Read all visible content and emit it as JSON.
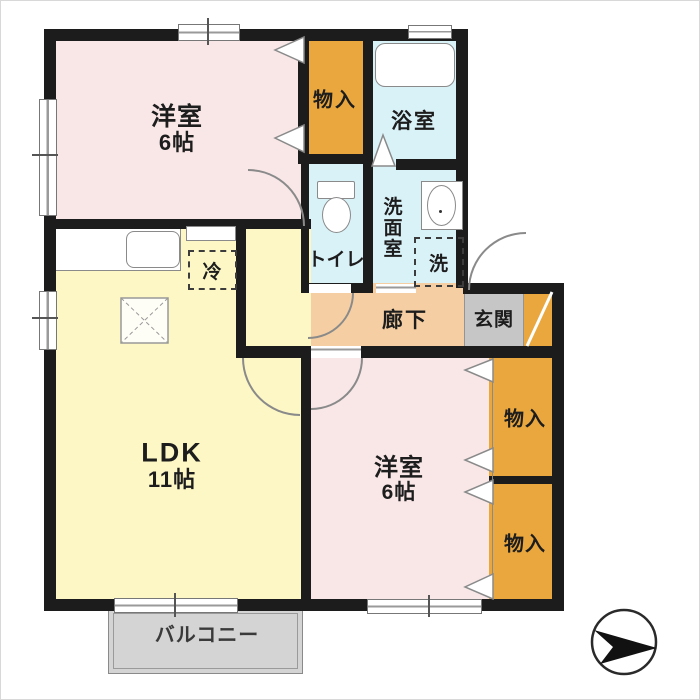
{
  "plan_title": "2LDK apartment floor plan",
  "rooms": {
    "bedroom1": {
      "name": "洋室",
      "size": "6帖"
    },
    "bedroom2": {
      "name": "洋室",
      "size": "6帖"
    },
    "ldk": {
      "name": "LDK",
      "size": "11帖"
    },
    "bath": {
      "name": "浴室"
    },
    "toilet": {
      "name": "トイレ"
    },
    "washroom": {
      "name": "洗面室"
    },
    "hallway": {
      "name": "廊下"
    },
    "entrance": {
      "name": "玄関"
    },
    "balcony": {
      "name": "バルコニー"
    },
    "storage_top": {
      "name": "物入"
    },
    "storage_right_upper": {
      "name": "物入"
    },
    "storage_right_lower": {
      "name": "物入"
    }
  },
  "appliances": {
    "refrigerator": "冷",
    "washer": "洗"
  },
  "icons": {
    "compass": "north-arrow-icon",
    "doors": "quarter-circle-swing",
    "closets": "folding-door-chevron"
  },
  "colors": {
    "wall": "#1c1c1c",
    "bedroom": "#f9e7e7",
    "ldk": "#fcf7c5",
    "wet_area": "#d9f2f8",
    "hallway": "#f5cfa3",
    "storage": "#e9a73e",
    "entrance_floor": "#c6c6c6",
    "entrance_step": "#e9a73e",
    "balcony": "#d4d4d4"
  }
}
